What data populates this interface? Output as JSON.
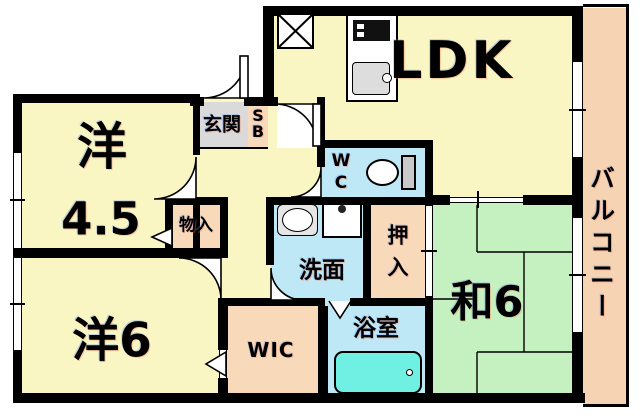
{
  "plan_type": "apartment-floorplan",
  "colors": {
    "wall": "#000000",
    "room-yellow": "#F9F6C4",
    "tatami-green": "#C5F0C0",
    "wet-blue": "#BEE8F5",
    "closet-peach": "#F8DABB",
    "balcony-peach": "#F6D3B3",
    "entrance-gray": "#DADADA",
    "bathtub-cyan": "#6FF0E3"
  },
  "rooms": {
    "ldk": {
      "label": "LDK"
    },
    "western_4_5": {
      "kanji": "洋",
      "size": "4.5"
    },
    "western_6": {
      "label": "洋6"
    },
    "japanese_6": {
      "label": "和6"
    },
    "balcony": {
      "label": "バルコニー"
    },
    "entrance": {
      "label": "玄関"
    },
    "shoe_box": {
      "line1": "S",
      "line2": "B"
    },
    "toilet_room": {
      "line1": "W",
      "line2": "C"
    },
    "washroom": {
      "label": "洗面"
    },
    "futon_closet": {
      "line1": "押",
      "line2": "入"
    },
    "bathroom": {
      "label": "浴室"
    },
    "walk_in_closet": {
      "label": "WIC"
    },
    "storage": {
      "label": "物入"
    }
  },
  "fixtures": {
    "stove": "gas-stove",
    "kitchen_sink": "kitchen-sink",
    "refrigerator_space": "x-box-space",
    "toilet": "toilet",
    "washbasin": "washbasin",
    "washer_pan": "washing-machine-pan",
    "bathtub": "bathtub"
  }
}
